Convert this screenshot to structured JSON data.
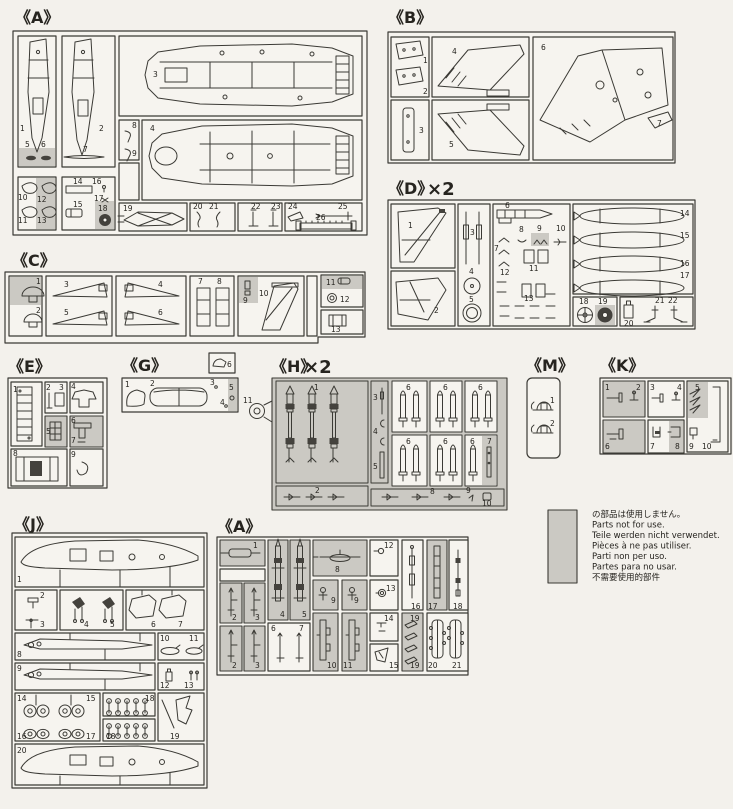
{
  "colors": {
    "paper": "#f3f1ec",
    "box_fill": "#f6f4ef",
    "line": "#3b3a35",
    "shade": "#cbc9c3",
    "dark": "#44423d"
  },
  "panels": {
    "A1": {
      "label": "《A》",
      "multiplier": "",
      "parts": [
        "1",
        "2",
        "3",
        "4",
        "5",
        "6",
        "7",
        "8",
        "9",
        "10",
        "11",
        "12",
        "13",
        "14",
        "15",
        "16",
        "17",
        "18",
        "19",
        "20",
        "21",
        "22",
        "23",
        "24",
        "25",
        "26"
      ]
    },
    "B": {
      "label": "《B》",
      "multiplier": "",
      "parts": [
        "1",
        "2",
        "3",
        "4",
        "5",
        "6",
        "7"
      ]
    },
    "D": {
      "label": "《D》",
      "multiplier": "×2",
      "parts": [
        "1",
        "2",
        "3",
        "4",
        "5",
        "6",
        "7",
        "8",
        "9",
        "10",
        "11",
        "12",
        "13",
        "14",
        "15",
        "16",
        "17",
        "18",
        "19",
        "20",
        "21",
        "22"
      ]
    },
    "C": {
      "label": "《C》",
      "multiplier": "",
      "parts": [
        "1",
        "2",
        "3",
        "4",
        "5",
        "6",
        "7",
        "8",
        "9",
        "10",
        "11",
        "12",
        "13"
      ]
    },
    "E": {
      "label": "《E》",
      "multiplier": "",
      "parts": [
        "1",
        "2",
        "3",
        "4",
        "5",
        "6",
        "7",
        "8",
        "9"
      ]
    },
    "G": {
      "label": "《G》",
      "multiplier": "",
      "parts": [
        "1",
        "2",
        "3",
        "4",
        "5",
        "6"
      ]
    },
    "H": {
      "label": "《H》",
      "multiplier": "×2",
      "parts": [
        "1",
        "2",
        "3",
        "4",
        "5",
        "6",
        "7",
        "8",
        "9",
        "10",
        "11"
      ]
    },
    "M": {
      "label": "《M》",
      "multiplier": "",
      "parts": [
        "1",
        "2"
      ]
    },
    "K": {
      "label": "《K》",
      "multiplier": "",
      "parts": [
        "1",
        "2",
        "3",
        "4",
        "5",
        "6",
        "7",
        "8",
        "9",
        "10"
      ]
    },
    "J": {
      "label": "《J》",
      "multiplier": "",
      "parts": [
        "1",
        "2",
        "3",
        "4",
        "5",
        "6",
        "7",
        "8",
        "9",
        "10",
        "11",
        "12",
        "13",
        "14",
        "15",
        "16",
        "17",
        "18",
        "19",
        "20"
      ]
    },
    "A2": {
      "label": "《A》",
      "multiplier": "",
      "parts": [
        "1",
        "2",
        "3",
        "4",
        "5",
        "6",
        "7",
        "8",
        "9",
        "10",
        "11",
        "12",
        "13",
        "14",
        "15",
        "16",
        "17",
        "18",
        "19",
        "20",
        "21"
      ]
    }
  },
  "legend": {
    "lines": [
      "の部品は使用しません。",
      "Parts not for use.",
      "Teile werden nicht verwendet.",
      "Pièces à ne pas utiliser.",
      "Parti non per uso.",
      "Partes para no usar.",
      "不需要使用的部件"
    ]
  }
}
